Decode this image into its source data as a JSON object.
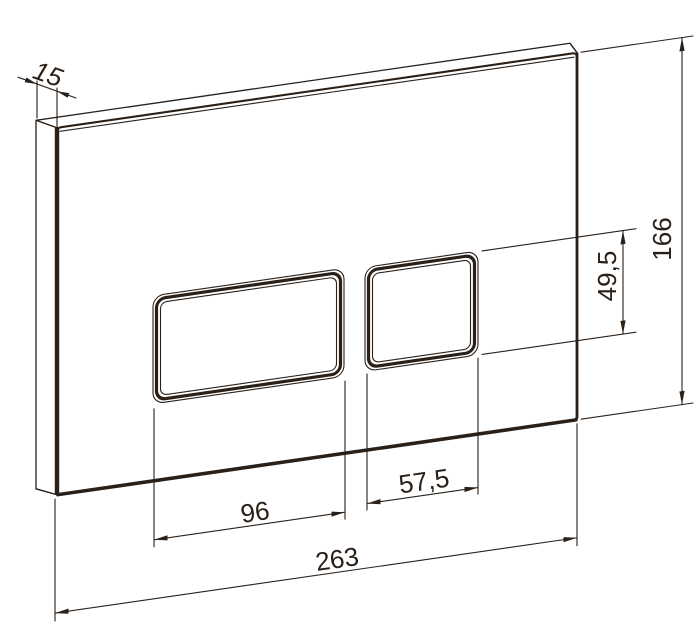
{
  "diagram": {
    "kind": "technical-drawing",
    "subject": "dual-flush-plate-perspective-view",
    "dimensions": {
      "thickness": "15",
      "plate_height": "166",
      "button_height": "49,5",
      "large_button_width": "96",
      "small_button_width": "57,5",
      "plate_width": "263"
    },
    "colors": {
      "line": "#2a2018",
      "background": "#ffffff"
    }
  }
}
